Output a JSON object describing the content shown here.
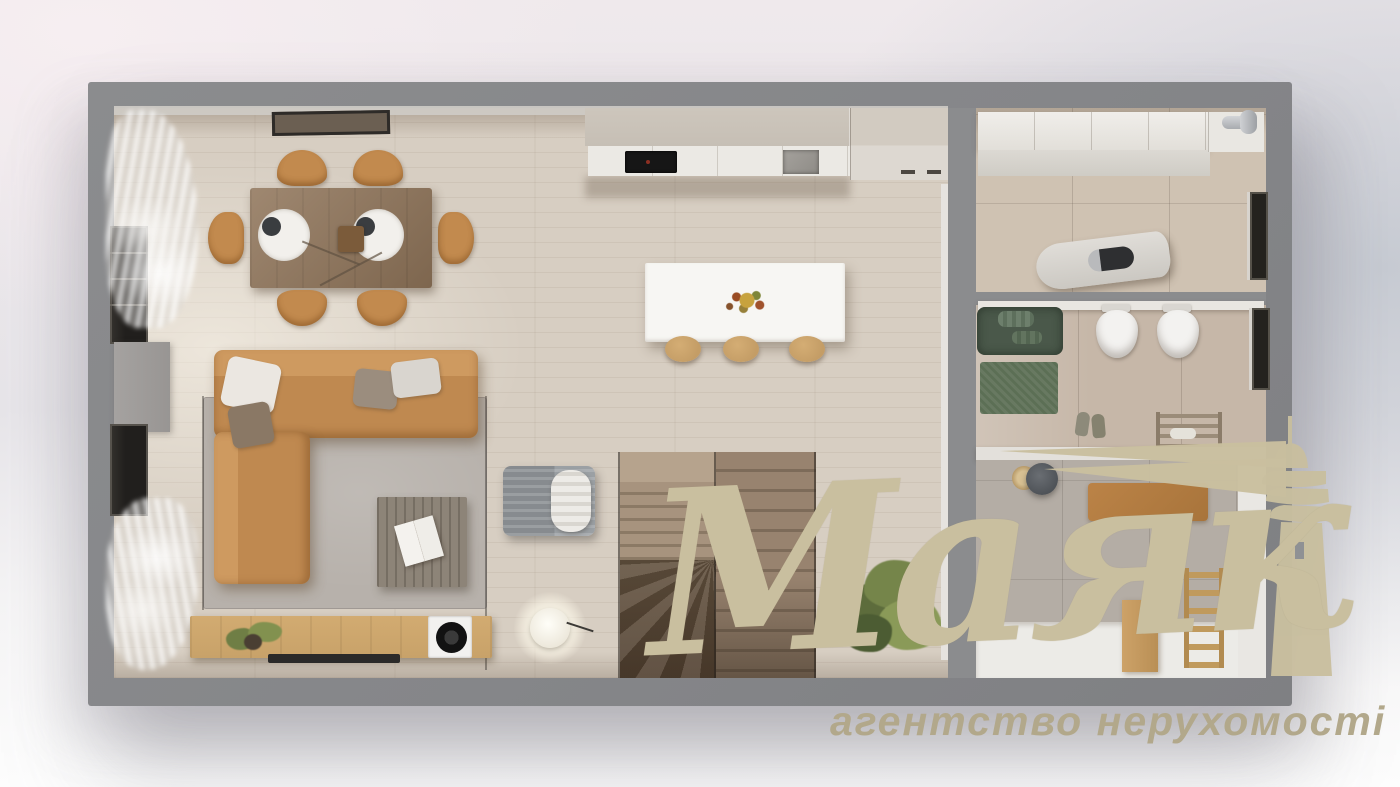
{
  "scene": {
    "type": "apartment-floor-plan-3d-render-top-view",
    "description": "Top-down 3D render of a furnished apartment: living-dining room with corner sofa, kitchen with island, stairs, utility room, bathroom and hallway"
  },
  "watermark": {
    "brand": "Маяк",
    "tagline": "агентство нерухомості",
    "icon": "lighthouse-with-light-beam-icon",
    "brand_color": "#c9bf9f",
    "tagline_color": "#b2a88b"
  },
  "palette": {
    "wall": "#8b8c8e",
    "wall_inner_face": "#cfccc7",
    "floor_wood": "#d7cec2",
    "tile_utility": "#cfc2b2",
    "tile_bath": "#c6b7a8",
    "tile_hall": "#b4ada5",
    "cabinet_greige": "#c6bfb5",
    "counter_white": "#ebe9e4",
    "island_white": "#f7f6f3",
    "sofa_camel": "#bf8950",
    "chair_camel": "#c28a4e",
    "stool_wood": "#c49d66",
    "table_wood": "#8f7459",
    "rug_gray": "#b7b1ab",
    "oak_sideboard": "#c8a269",
    "tub_green": "#4a584a",
    "rug_green": "#5c6f55",
    "plant_green": "#6d7c46",
    "gold": "#c9bf9f",
    "gold_text": "#b2a88b"
  },
  "rooms": {
    "living_dining_kitchen": {
      "objects": [
        "dining-table",
        "dining-chairs",
        "corner-sofa",
        "pillows",
        "gray-rug",
        "coffee-table",
        "lounge-chair",
        "tv-sideboard",
        "record-player",
        "floor-lamp",
        "plant",
        "kitchen-cabinets",
        "cooktop",
        "sink",
        "kitchen-island",
        "bar-stools",
        "fruit-bowl",
        "stairs",
        "curtains",
        "windows",
        "picture-frame"
      ]
    },
    "utility_room": {
      "objects": [
        "wall-cabinets",
        "vent-pipe",
        "ironing-board",
        "iron",
        "window-niche"
      ]
    },
    "bathroom": {
      "objects": [
        "green-bathtub",
        "towels",
        "wall-hung-toilets",
        "green-rug",
        "slippers",
        "towel-ladder",
        "window-niche"
      ]
    },
    "hallway": {
      "objects": [
        "pendant-lamp",
        "doormat",
        "closet",
        "wooden-ladder",
        "wooden-cabinet"
      ]
    }
  }
}
